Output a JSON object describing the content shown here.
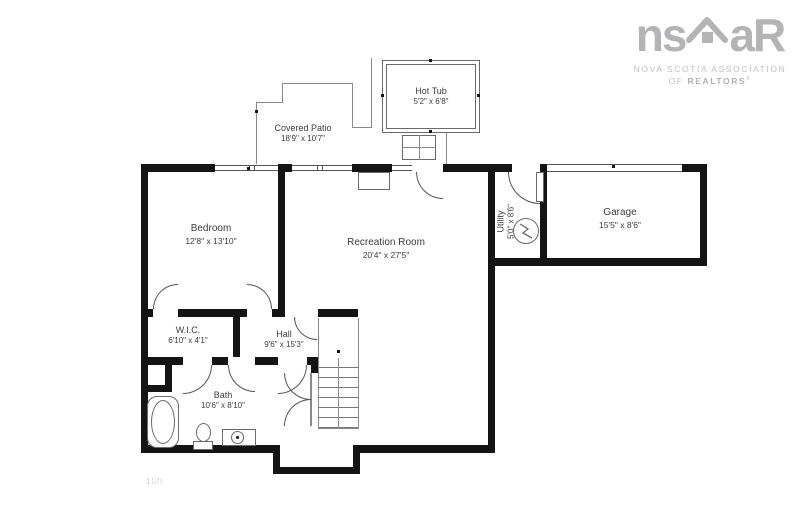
{
  "plan_title": "basement floor plan",
  "rooms": {
    "hot_tub": {
      "name": "Hot Tub",
      "dims": "5'2\" x 6'8\""
    },
    "patio": {
      "name": "Covered Patio",
      "dims": "18'9\" x 10'7\""
    },
    "bedroom": {
      "name": "Bedroom",
      "dims": "12'8\" x 13'10\""
    },
    "recreation": {
      "name": "Recreation Room",
      "dims": "20'4\" x 27'5\""
    },
    "garage": {
      "name": "Garage",
      "dims": "15'5\" x 8'6\""
    },
    "utility": {
      "name": "Utility",
      "dims": "5'0\" x 8'6\""
    },
    "wic": {
      "name": "W.I.C.",
      "dims": "6'10\" x 4'1\""
    },
    "hall": {
      "name": "Hall",
      "dims": "9'6\" x 15'3\""
    },
    "bath": {
      "name": "Bath",
      "dims": "10'6\" x 8'10\""
    }
  },
  "logo": {
    "text_ns": "ns",
    "text_ar": "aR",
    "subtitle_line1": "NOVA SCOTIA ASSOCIATION",
    "subtitle_line2_prefix": "OF ",
    "subtitle_line2_bold": "REALTORS",
    "registered_mark": "®",
    "color": "#b4b4b7"
  },
  "watermark": "10ft",
  "colors": {
    "wall": "#141414",
    "thin_line": "#8a8a8a",
    "label_text": "#3c3c3c"
  }
}
